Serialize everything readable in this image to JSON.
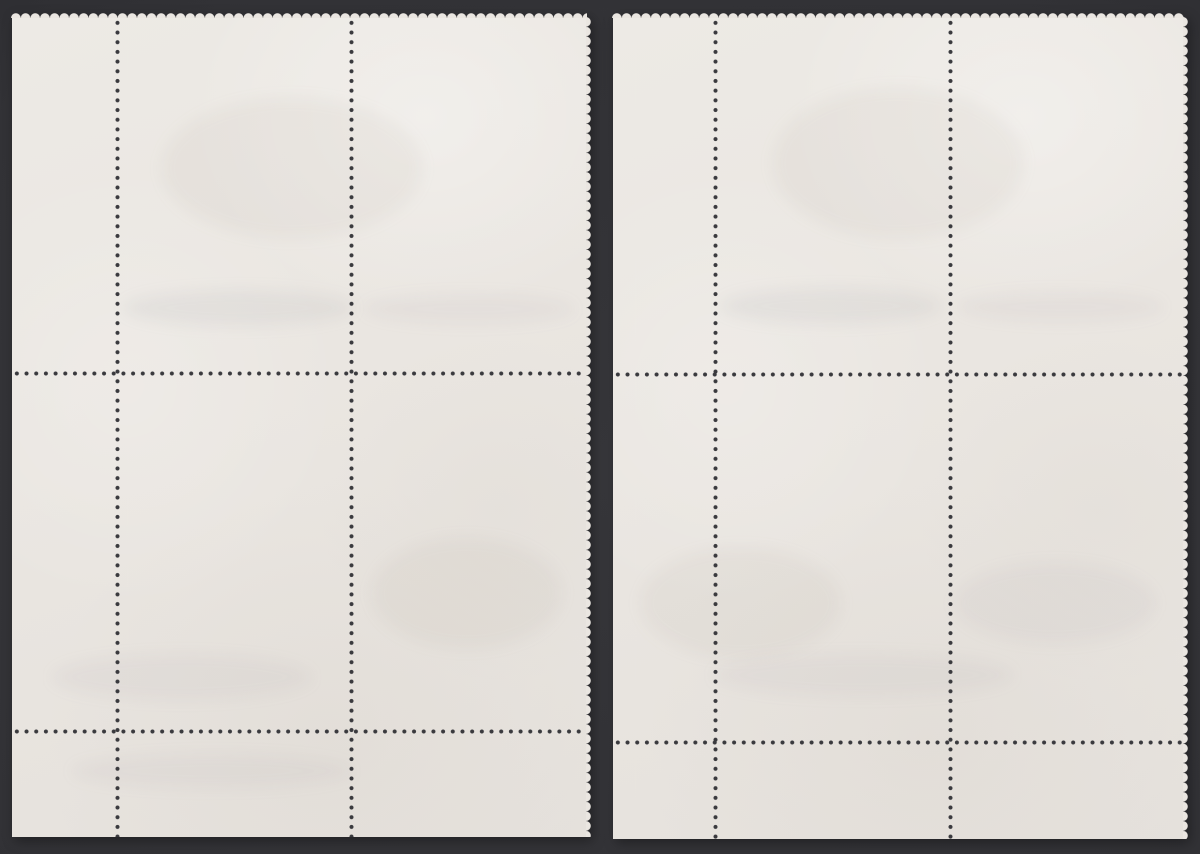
{
  "scene": {
    "description": "Photograph of two blank corner blocks of perforated postage-stamp sheets, shown from the reverse (gum) side, lying on a dark charcoal surface",
    "background_color": "#37373b",
    "background_edge_color": "#222226",
    "paper_color": "#eae6e1",
    "perforation_hole_color": "#3a3a3e",
    "perforation_pitch_px": 9.7
  },
  "sheets": [
    {
      "id": "left-block",
      "label": "Left stamp corner block: 2 by 2 stamps with selvage margin on left and bottom, perforated tooth edges on top and right, straight cut edges on left and bottom, 2 vertical and 2 horizontal perforation lines",
      "stamp_rows": 2,
      "stamp_columns": 2,
      "selvage_edges": [
        "left",
        "bottom"
      ],
      "perforated_edges": [
        "top",
        "right"
      ],
      "straight_cut_edges": [
        "left",
        "bottom"
      ],
      "vertical_perforation_lines": 2,
      "horizontal_perforation_lines": 2
    },
    {
      "id": "right-block",
      "label": "Right stamp corner block: 2 by 2 stamps with selvage margin on left and bottom, perforated tooth edges on top and right, straight cut edges on left and bottom, 2 vertical and 2 horizontal perforation lines",
      "stamp_rows": 2,
      "stamp_columns": 2,
      "selvage_edges": [
        "left",
        "bottom"
      ],
      "perforated_edges": [
        "top",
        "right"
      ],
      "straight_cut_edges": [
        "left",
        "bottom"
      ],
      "vertical_perforation_lines": 2,
      "horizontal_perforation_lines": 2
    }
  ]
}
